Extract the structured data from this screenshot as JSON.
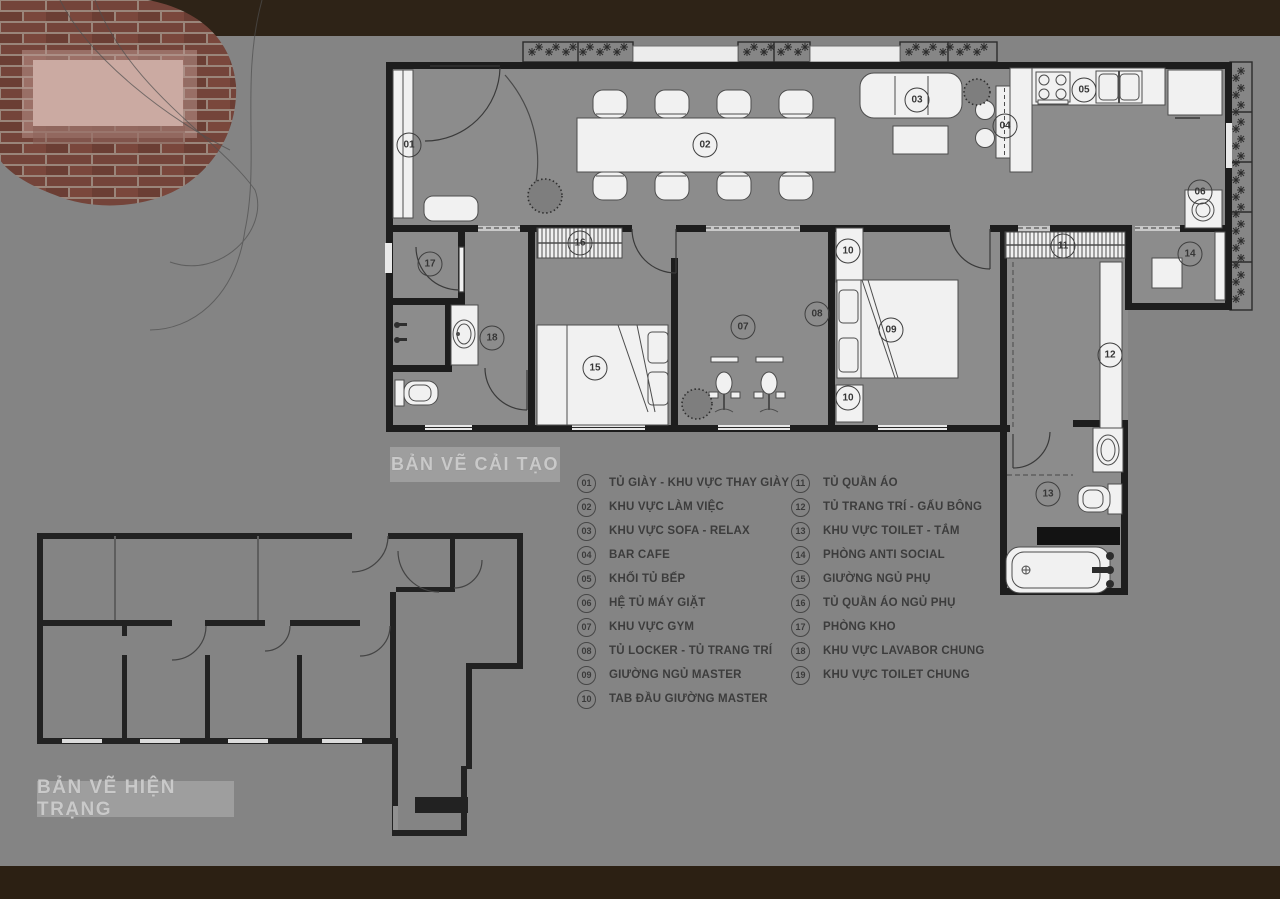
{
  "titles": {
    "renovation": "BẢN VẼ CẢI TẠO",
    "existing": "BẢN VẼ HIỆN TRẠNG"
  },
  "legend": {
    "column_split": 10,
    "items": [
      {
        "num": "01",
        "label": "TỦ GIÀY - KHU VỰC THAY GIÀY"
      },
      {
        "num": "02",
        "label": "KHU VỰC LÀM VIỆC"
      },
      {
        "num": "03",
        "label": "KHU VỰC SOFA - RELAX"
      },
      {
        "num": "04",
        "label": "BAR CAFE"
      },
      {
        "num": "05",
        "label": "KHỐI TỦ BẾP"
      },
      {
        "num": "06",
        "label": "HỆ TỦ MÁY GIẶT"
      },
      {
        "num": "07",
        "label": "KHU VỰC GYM"
      },
      {
        "num": "08",
        "label": "TỦ LOCKER - TỦ TRANG TRÍ"
      },
      {
        "num": "09",
        "label": "GIƯỜNG NGỦ MASTER"
      },
      {
        "num": "10",
        "label": "TAB ĐẦU GIƯỜNG MASTER"
      },
      {
        "num": "11",
        "label": "TỦ QUẦN ÁO"
      },
      {
        "num": "12",
        "label": "TỦ TRANG TRÍ - GẤU BÔNG"
      },
      {
        "num": "13",
        "label": "KHU VỰC TOILET - TẮM"
      },
      {
        "num": "14",
        "label": "PHÒNG ANTI SOCIAL"
      },
      {
        "num": "15",
        "label": "GIƯỜNG NGỦ PHỤ"
      },
      {
        "num": "16",
        "label": "TỦ QUẦN ÁO NGỦ PHỤ"
      },
      {
        "num": "17",
        "label": "PHÒNG KHO"
      },
      {
        "num": "18",
        "label": "KHU VỰC LAVABOR CHUNG"
      },
      {
        "num": "19",
        "label": "KHU VỰC TOILET CHUNG"
      }
    ]
  },
  "markers": [
    {
      "num": "01",
      "x": 409,
      "y": 145
    },
    {
      "num": "02",
      "x": 705,
      "y": 145
    },
    {
      "num": "03",
      "x": 917,
      "y": 100
    },
    {
      "num": "04",
      "x": 1005,
      "y": 126
    },
    {
      "num": "05",
      "x": 1084,
      "y": 90
    },
    {
      "num": "06",
      "x": 1200,
      "y": 192
    },
    {
      "num": "07",
      "x": 743,
      "y": 327
    },
    {
      "num": "08",
      "x": 817,
      "y": 314
    },
    {
      "num": "09",
      "x": 891,
      "y": 330
    },
    {
      "num": "10",
      "x": 848,
      "y": 251
    },
    {
      "num": "10",
      "x": 848,
      "y": 398
    },
    {
      "num": "11",
      "x": 1063,
      "y": 246
    },
    {
      "num": "12",
      "x": 1110,
      "y": 355
    },
    {
      "num": "13",
      "x": 1048,
      "y": 494
    },
    {
      "num": "14",
      "x": 1190,
      "y": 254
    },
    {
      "num": "15",
      "x": 595,
      "y": 368
    },
    {
      "num": "16",
      "x": 580,
      "y": 243
    },
    {
      "num": "17",
      "x": 430,
      "y": 264
    },
    {
      "num": "18",
      "x": 492,
      "y": 338
    }
  ],
  "colors": {
    "background": "#848484",
    "border_band": "#2e2317",
    "walls": "#1d1d1d",
    "furniture": "#f1f1f1",
    "title_box": "#9e9e9e",
    "title_text": "#c9c9c9",
    "legend_text": "#3c3c3c",
    "brick": "#74443a"
  }
}
